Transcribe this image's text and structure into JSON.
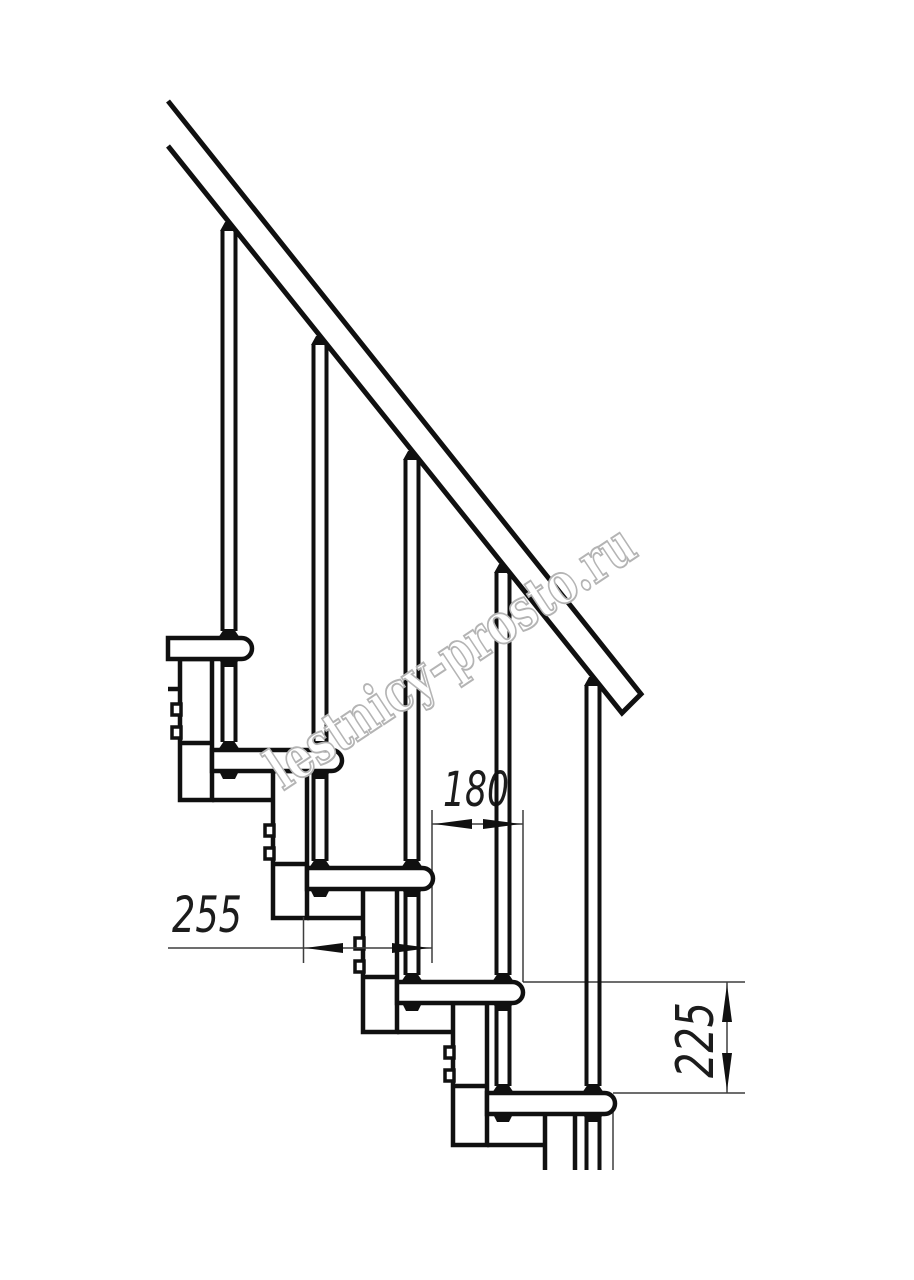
{
  "title": "Modular staircase side-view technical drawing",
  "watermark": {
    "text": "lestnicy-prosto.ru"
  },
  "dimensions": {
    "tread_depth_mm": "255",
    "step_run_mm": "180",
    "step_rise_mm": "225"
  },
  "colors": {
    "line": "#101010",
    "dimension": "#3d3d3d",
    "watermark": "#b4b4b4",
    "background": "#ffffff"
  }
}
